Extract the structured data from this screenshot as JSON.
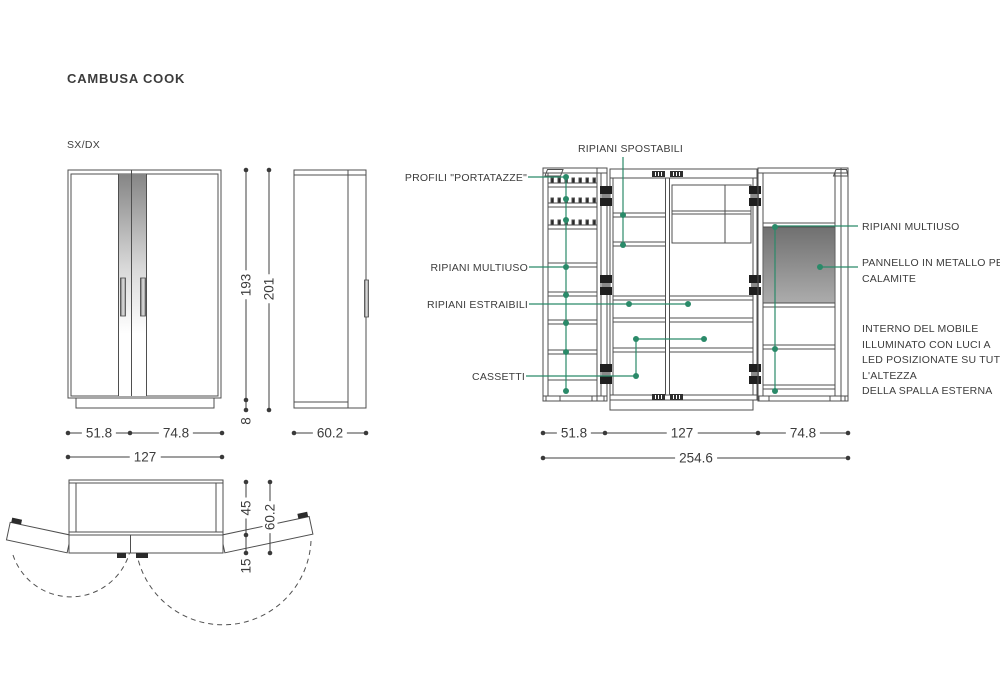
{
  "page": {
    "title": "CAMBUSA COOK",
    "variant_label": "SX/DX"
  },
  "annotations": {
    "ripiani_spostabili": "RIPIANI SPOSTABILI",
    "profili_portatazze": "PROFILI \"PORTATAZZE\"",
    "ripiani_multiuso_left": "RIPIANI MULTIUSO",
    "ripiani_estraibili": "RIPIANI ESTRAIBILI",
    "cassetti": "CASSETTI",
    "ripiani_multiuso_right": "RIPIANI MULTIUSO",
    "pannello_line1": "PANNELLO IN METALLO PER",
    "pannello_line2": "CALAMITE",
    "interno_lines": [
      "INTERNO DEL MOBILE",
      "ILLUMINATO CON LUCI A",
      "LED POSIZIONATE SU TUTTA",
      "L'ALTEZZA",
      "DELLA SPALLA ESTERNA"
    ]
  },
  "dimensions": {
    "front": {
      "left": "51.8",
      "right": "74.8",
      "total": "127",
      "carcass_height": "193",
      "total_height": "201",
      "plinth_height": "8"
    },
    "side": {
      "depth": "60.2"
    },
    "open": {
      "left": "51.8",
      "center": "127",
      "right": "74.8",
      "total": "254.6"
    },
    "plan": {
      "carcass_depth": "45",
      "door_depth": "15",
      "total_depth": "60.2"
    }
  },
  "colors": {
    "accent_green": "#2A8A69",
    "line": "#4F4F4F",
    "text": "#3C3C3C"
  }
}
